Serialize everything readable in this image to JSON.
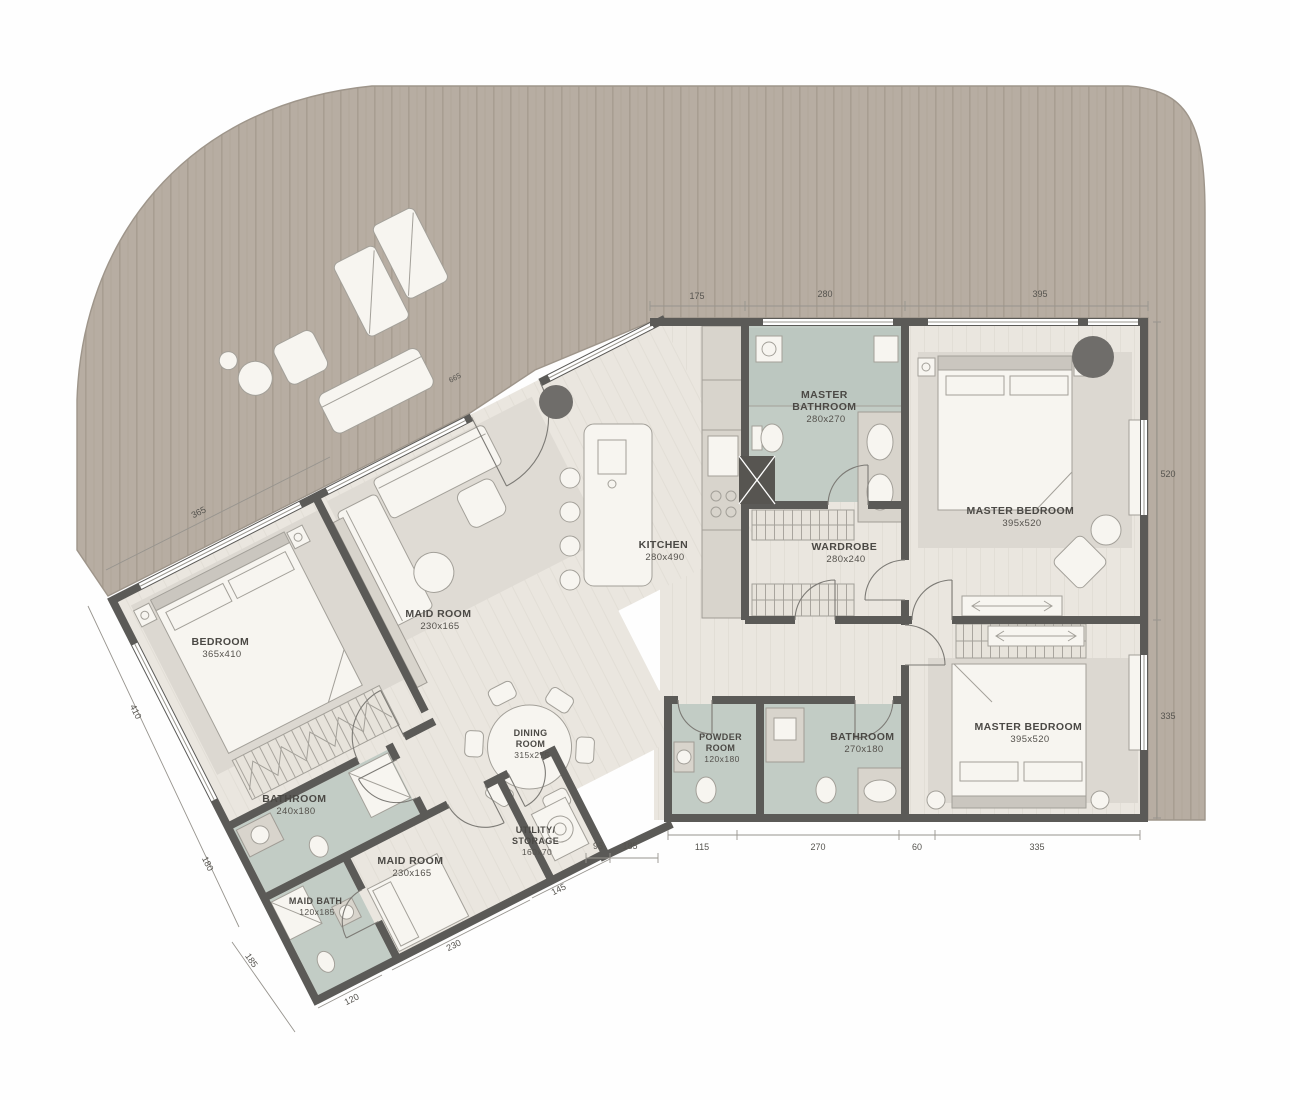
{
  "type": "apartment-floor-plan",
  "rooms": {
    "master_bathroom": {
      "name": "MASTER BATHROOM",
      "size": "280x270",
      "lines": [
        "MASTER",
        "BATHROOM",
        "280x270"
      ]
    },
    "master_bedroom_top": {
      "name": "MASTER BEDROOM",
      "size": "395x520",
      "lines": [
        "MASTER BEDROOM",
        "395x520"
      ]
    },
    "kitchen": {
      "name": "KITCHEN",
      "size": "280x490",
      "lines": [
        "KITCHEN",
        "280x490"
      ]
    },
    "wardrobe": {
      "name": "WARDROBE",
      "size": "280x240",
      "lines": [
        "WARDROBE",
        "280x240"
      ]
    },
    "maid_room_center": {
      "name": "MAID ROOM",
      "size": "230x165",
      "lines": [
        "MAID ROOM",
        "230x165"
      ]
    },
    "bedroom": {
      "name": "BEDROOM",
      "size": "365x410",
      "lines": [
        "BEDROOM",
        "365x410"
      ]
    },
    "dining_room": {
      "name": "DINING ROOM",
      "size": "315x275",
      "lines": [
        "DINING",
        "ROOM",
        "315x275"
      ]
    },
    "bathroom_left": {
      "name": "BATHROOM",
      "size": "240x180",
      "lines": [
        "BATHROOM",
        "240x180"
      ]
    },
    "maid_bath": {
      "name": "MAID BATH",
      "size": "120x185",
      "lines": [
        "MAID BATH",
        "120x185"
      ]
    },
    "maid_room_lower": {
      "name": "MAID ROOM",
      "size": "230x165",
      "lines": [
        "MAID ROOM",
        "230x165"
      ]
    },
    "utility_storage": {
      "name": "UTILITY/ STORAGE",
      "size": "160x70",
      "lines": [
        "UTILITY/",
        "STORAGE",
        "160x70"
      ]
    },
    "powder_room": {
      "name": "POWDER ROOM",
      "size": "120x180",
      "lines": [
        "POWDER",
        "ROOM",
        "120x180"
      ]
    },
    "bathroom_right": {
      "name": "BATHROOM",
      "size": "270x180",
      "lines": [
        "BATHROOM",
        "270x180"
      ]
    },
    "master_bedroom_bottom": {
      "name": "MASTER BEDROOM",
      "size": "395x520",
      "lines": [
        "MASTER BEDROOM",
        "395x520"
      ]
    }
  },
  "dimensions": {
    "top": [
      "175",
      "280",
      "395"
    ],
    "right": [
      "520",
      "335"
    ],
    "bottom": [
      "115",
      "270",
      "60",
      "335"
    ],
    "left": [
      "365",
      "410",
      "180",
      "185"
    ],
    "bottom_left": [
      "120",
      "230",
      "145"
    ],
    "inner_bottom": [
      "95",
      "185"
    ],
    "entrance": "665"
  },
  "colors": {
    "deck": "#b7ada2",
    "deck_stripe": "#a89e92",
    "floor": "#eae6df",
    "wet_floor": "#c2ccc5",
    "wall": "#5b5a57",
    "rug": "#dcd8d1",
    "label_text": "#4b4945"
  }
}
